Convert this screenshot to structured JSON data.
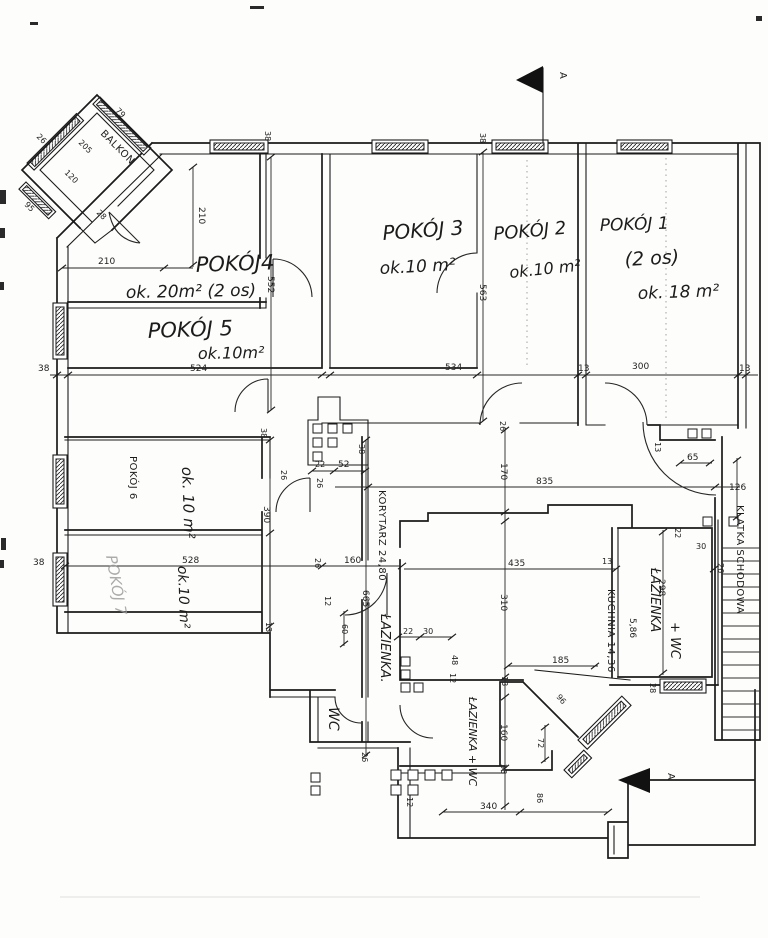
{
  "plan": {
    "section_marker": "A",
    "rooms": {
      "p1_name": "POKÓJ 1",
      "p1_occupancy": "(2 os)",
      "p1_area": "ok. 18 m²",
      "p2_name": "POKÓJ 2",
      "p2_area": "ok.10 m²",
      "p3_name": "POKÓJ 3",
      "p3_area": "ok.10 m²",
      "p4_name": "POKÓJ4",
      "p4_area": "ok. 20m² (2 os)",
      "p5_name": "POKÓJ 5",
      "p5_area": "ok.10m²",
      "p6_name": "POKÓJ 6",
      "p6_area": "ok. 10 m²",
      "p7_name": "POKÓJ 7",
      "p7_area": "ok.10 m²",
      "korytarz": "KORYTARZ 24,80",
      "kuchnia": "KUCHNIA 14,36",
      "lazienka_center": "ŁAZIENKA.",
      "lazienka_wc_center": "ŁAZIENKA + WC",
      "lazienka_right": "ŁAZIENKA",
      "lazienka_right_wc": "+ WC",
      "wc": "WC",
      "balkon": "BALKON",
      "klatka_schodowa": "KLATKA SCHODOWA"
    },
    "dims": {
      "d12": "12",
      "d13": "13",
      "d22": "22",
      "d26": "26",
      "d28": "28",
      "d30": "30",
      "d38": "38",
      "d48": "48",
      "d52": "52",
      "d60": "60",
      "d65": "65",
      "d72": "72",
      "d79": "79",
      "d86": "86",
      "d95": "95",
      "d96": "96",
      "d120": "120",
      "d126": "126",
      "d160": "160",
      "d170": "170",
      "d185": "185",
      "d205": "205",
      "d210": "210",
      "d298": "298",
      "d300": "300",
      "d310": "310",
      "d340": "340",
      "d390": "390",
      "d435": "435",
      "d524": "524",
      "d528": "528",
      "d534": "534",
      "d552": "552",
      "d563": "563",
      "d586": "5,86",
      "d665": "665",
      "d835": "835"
    }
  }
}
